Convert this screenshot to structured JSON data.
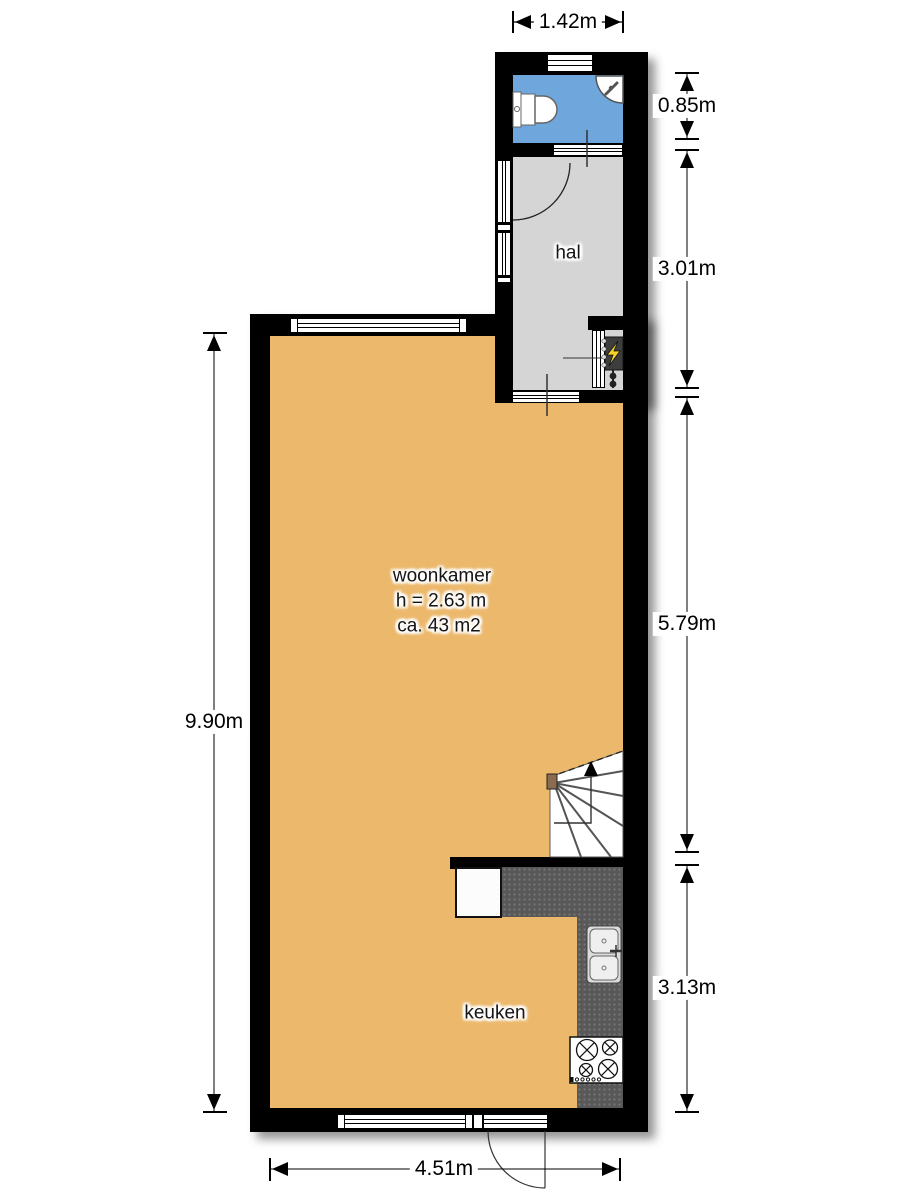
{
  "plan": {
    "rooms": {
      "hal": {
        "label": "hal"
      },
      "woonkamer": {
        "label": "woonkamer",
        "ceiling_height": "h = 2.63 m",
        "area": "ca. 43 m2"
      },
      "keuken": {
        "label": "keuken"
      }
    },
    "dimensions": {
      "top": "1.42m",
      "left": "9.90m",
      "bottom": "4.51m",
      "right": [
        "0.85m",
        "3.01m",
        "5.79m",
        "3.13m"
      ]
    },
    "colors": {
      "living_floor": "#ECB96C",
      "hall_floor": "#D5D5D5",
      "toilet_floor": "#6FA6DC",
      "wall": "#000000",
      "counter": "#585858",
      "stair_post": "#8A6C4E",
      "lightning": "#F5D327"
    }
  }
}
